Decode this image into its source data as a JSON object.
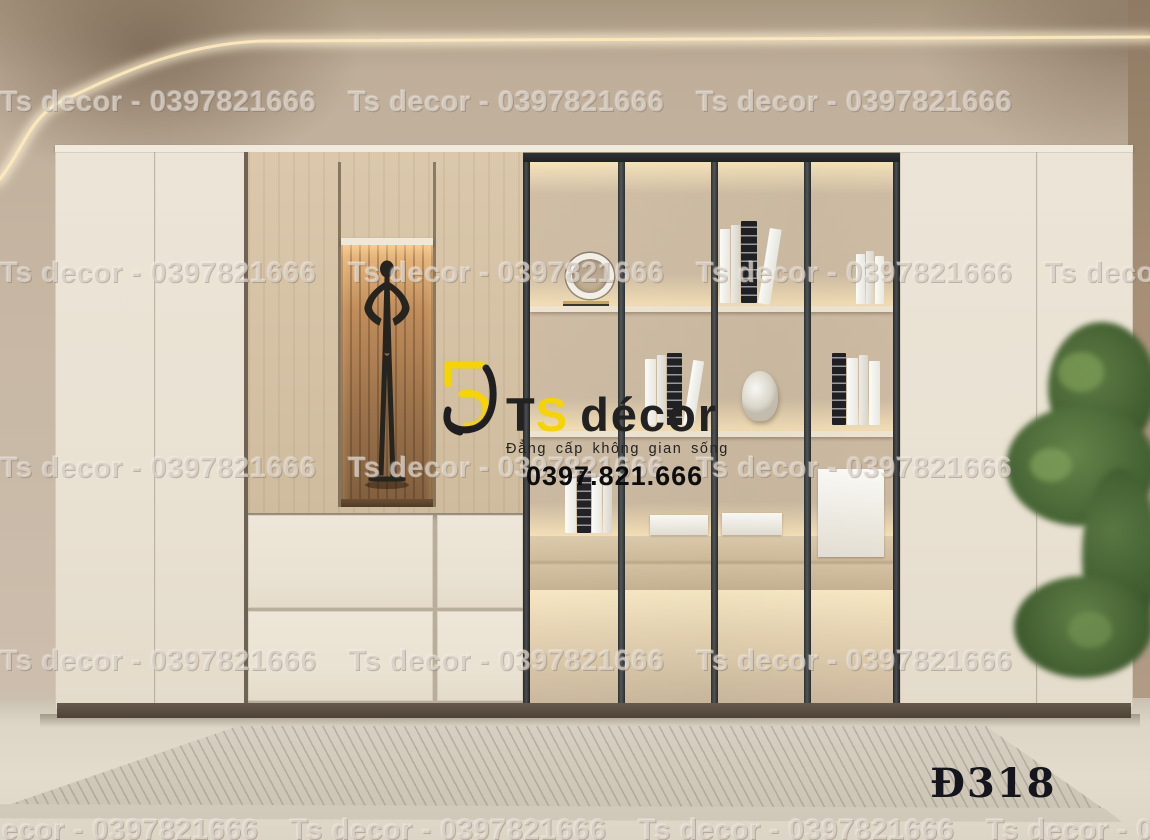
{
  "watermark": {
    "text": "Ts decor - 0397821666"
  },
  "logo": {
    "brand_t": "T",
    "brand_s": "S",
    "brand_decor": "décor",
    "tagline": "Đẳng cấp không gian sống",
    "phone": "0397.821.666"
  },
  "label": {
    "product_code": "Đ318"
  },
  "colors": {
    "accent_yellow": "#f5d400",
    "logo_black": "#1f1f22",
    "wall_taupe": "#c7b7a4",
    "cabinet_cream": "#ece5d7",
    "wood_light": "#d7c4a8",
    "niche_wood": "#9a714a",
    "mullion_dark": "#3a3d3f",
    "rug": "#d2cabb",
    "plant_green": "#4c6a3a"
  }
}
